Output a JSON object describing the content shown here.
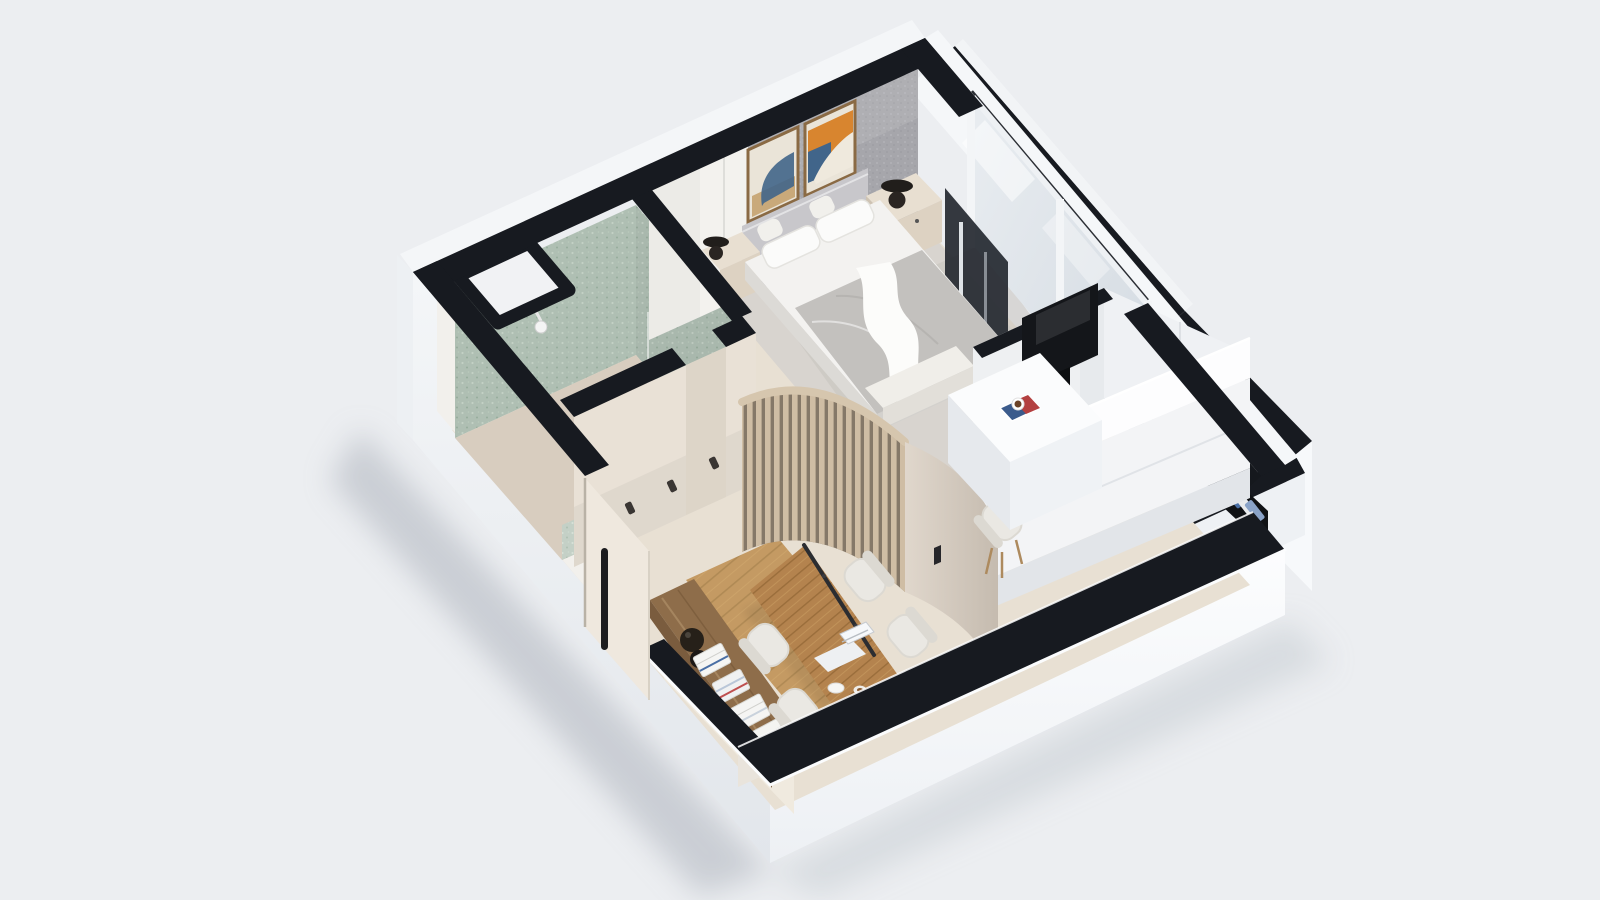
{
  "meta": {
    "image_type": "3d-isometric-floor-plan-render",
    "view": "top-down axonometric dollhouse cutaway",
    "text_visible": "none"
  },
  "colors": {
    "bg": "#eceef1",
    "ground_shadow": "#a9afb9",
    "wall_top": "#171a20",
    "wall_rim": "#fbfcfd",
    "wall_outer_left_top": "#f4f6f8",
    "wall_outer_left_bot": "#e3e7ec",
    "wall_outer_right_top": "#fcfdfe",
    "wall_outer_right_bot": "#eef1f5",
    "wall_white": "#f0f1f3",
    "wall_cream": "#e9e1d6",
    "accent_wall": "#a6a6ab",
    "tile_green": "#b7c6ba",
    "floor_cream": "#e8e0d3",
    "floor_bedroom": "#d8d4cf",
    "floor_bath": "#d8cdbf",
    "strip_cream": "#f0eadf",
    "wood_floor": "#c49a63",
    "wood_table": "#b4834e",
    "wood_dark": "#9c6f3f",
    "slat_wood": "#cfbda4",
    "slat_gap": "#857868",
    "curved_wall": "#d9d0c5",
    "headboard": "#c8c7cb",
    "bedding": "#f3f2f0",
    "duvet": "#c3c1be",
    "pillow": "#fbfbfa",
    "nightstand": "#ddd2c2",
    "lamp_black": "#211e1b",
    "glass": "#dee4e9",
    "frame_dark": "#262a31",
    "tv_black": "#14161a",
    "partition": "#eef0f2",
    "kitchen_white": "#f3f4f6",
    "kitchen_shadow": "#e2e5e9",
    "chair_white": "#eae8e3",
    "chair_shade": "#dcd9d2",
    "leg_wood": "#ad8a5e",
    "sideboard": "#8e6d4a",
    "sideboard_dark": "#7a5c3e",
    "vase_black": "#262019",
    "book_white": "#f5f5f3",
    "book_blue": "#4a6fa5",
    "book_red": "#bf5050",
    "door_cream": "#efe8de",
    "handle_dark": "#1d1d1f",
    "art_orange": "#d8852f",
    "art_blue": "#41658a",
    "art_cream": "#eae4d8",
    "frame_wood": "#8a6a44",
    "desk_white": "#fbfcfd",
    "desk_side": "#e6e9ed",
    "pendant": "#2b2d31",
    "magazine_blue": "#3b5b8c",
    "magazine_red": "#b34040",
    "cup_brown": "#6b4226",
    "niche_dark": "#101215"
  },
  "scene": {
    "building": "single studio apartment, cut walls shown with black tops, front walls cut low",
    "rooms": [
      {
        "name": "bedroom",
        "features": [
          "gray-accent-wall",
          "art-frame x2",
          "double-bed",
          "upholstered-headboard",
          "gray-duvet",
          "white-throw",
          "pillow x4",
          "nightstand x2",
          "sphere-lamp x2",
          "window-wall",
          "foot-bench",
          "dark-window-panel"
        ]
      },
      {
        "name": "bathroom",
        "features": [
          "green-tile-wall x2",
          "shower-head",
          "tiled-curb",
          "service-niche",
          "glass-divider",
          "door-opening"
        ]
      },
      {
        "name": "hallway",
        "features": [
          "coat-hook x3",
          "entry-door",
          "door-handle",
          "curved-slat-partition",
          "curved-solid-wall",
          "sliding-handle"
        ]
      },
      {
        "name": "living-dining",
        "features": [
          "wood-floor-area",
          "dining-table",
          "shell-chair x4",
          "laptop",
          "linear-pendant",
          "sideboard",
          "black-vase",
          "magazine-stack x4",
          "bowl",
          "cup"
        ]
      },
      {
        "name": "work-corner",
        "features": [
          "white-desk",
          "desk-chair",
          "magazine",
          "coffee-cup",
          "tv-partition",
          "wall-tv",
          "media-shelf"
        ]
      },
      {
        "name": "kitchen",
        "features": [
          "white-counter-block"
        ]
      },
      {
        "name": "entry-wing",
        "features": [
          "exterior-wall-slab",
          "corridor-void",
          "book-niche",
          "book x3"
        ]
      }
    ]
  }
}
